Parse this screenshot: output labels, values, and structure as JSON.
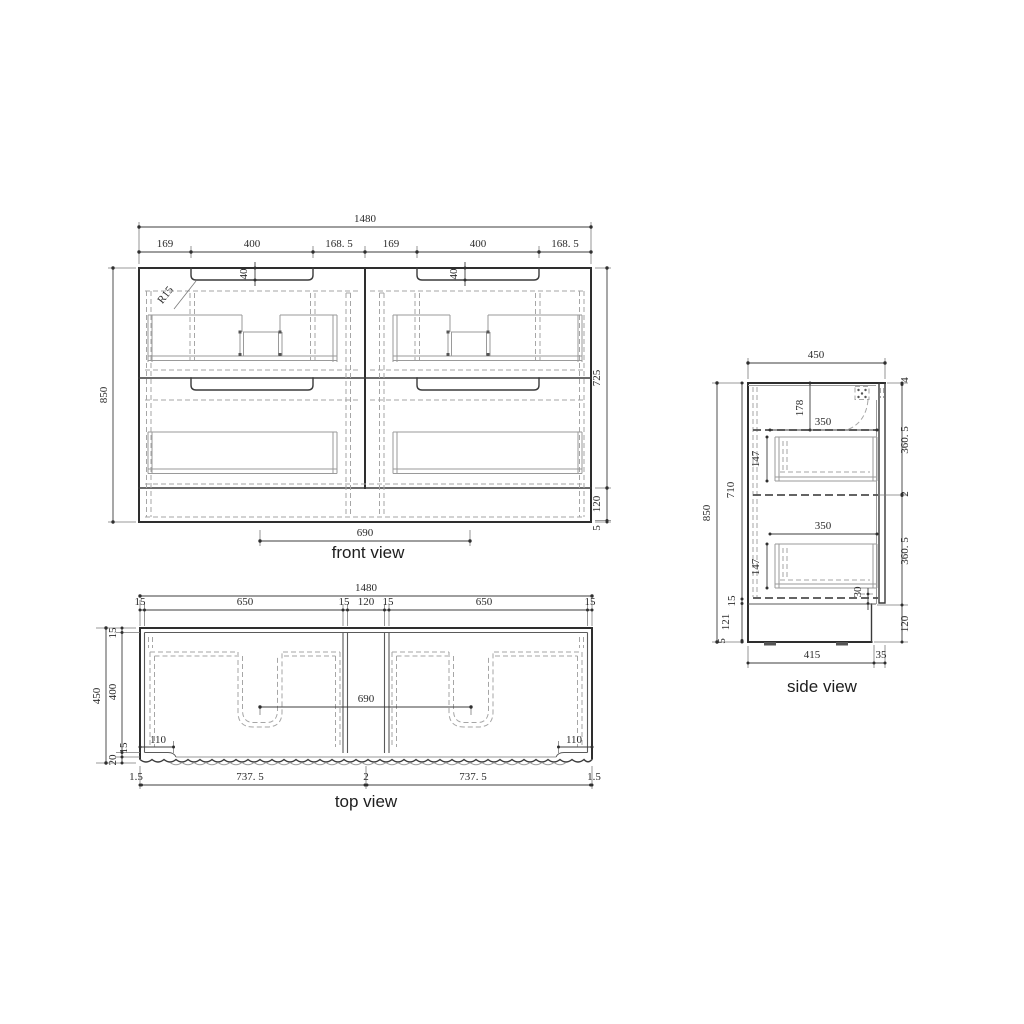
{
  "front_view": {
    "title": "front view",
    "overall_width": "1480",
    "width_segments": [
      "169",
      "400",
      "168. 5",
      "169",
      "400",
      "168. 5"
    ],
    "handle_recess_depth_left": "40",
    "handle_recess_depth_right": "40",
    "corner_radius": "R15",
    "overall_height": "850",
    "height_segments": [
      "725",
      "120",
      "5"
    ],
    "drain_spacing": "690"
  },
  "top_view": {
    "title": "top view",
    "overall_width": "1480",
    "width_segments": [
      "15",
      "650",
      "15",
      "120",
      "15",
      "650",
      "15"
    ],
    "overall_depth": "450",
    "depth_segments": [
      "15",
      "400",
      "15",
      "20"
    ],
    "basin_edge_offset_left": "110",
    "basin_edge_offset_right": "110",
    "basin_spacing": "690",
    "bottom_segments": [
      "1.5",
      "737. 5",
      "2",
      "737. 5",
      "1.5"
    ]
  },
  "side_view": {
    "title": "side view",
    "overall_depth": "450",
    "overall_height": "850",
    "left_segments": [
      "710",
      "15",
      "121",
      "5"
    ],
    "right_segments": [
      "4",
      "360. 5",
      "2",
      "360. 5",
      "120"
    ],
    "bottom_rail_height": "30",
    "benchtop_drop": "178",
    "top_drawer_depth": "350",
    "top_drawer_height": "147",
    "bottom_drawer_depth": "350",
    "bottom_drawer_height": "147",
    "bottom_segments": [
      "415",
      "35"
    ]
  },
  "style": {
    "background": "#ffffff",
    "outline_color": "#2e2e2e",
    "hidden_line_color": "#a6a6a6",
    "dimension_color": "#3c3c3c"
  }
}
